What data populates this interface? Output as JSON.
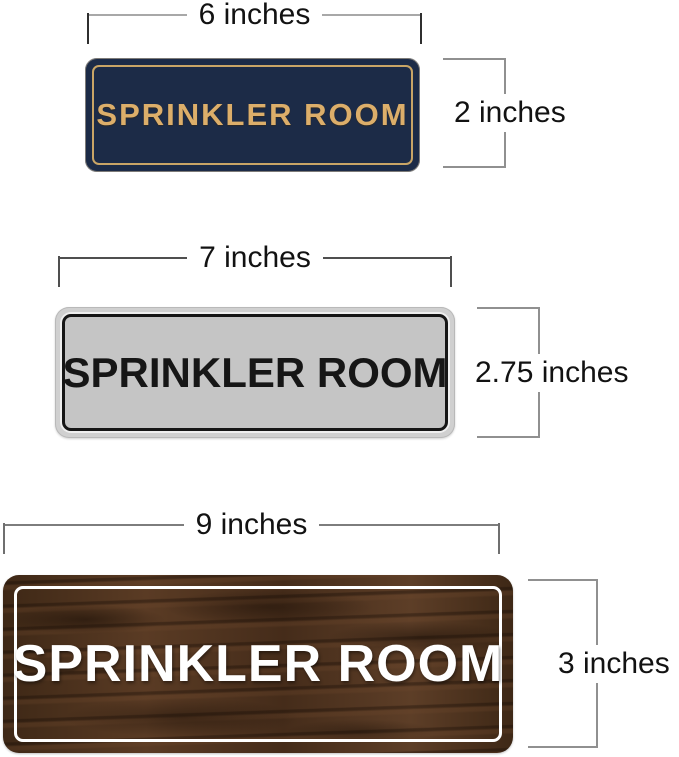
{
  "page": {
    "background": "#ffffff"
  },
  "signs": [
    {
      "name": "navy-gold-sign",
      "label": "SPRINKLER ROOM",
      "width_label": "6 inches",
      "height_label": "2 inches",
      "colors": {
        "face": "#1c2b47",
        "border": "#c9a566",
        "text": "#dcae6a"
      }
    },
    {
      "name": "silver-black-sign",
      "label": "SPRINKLER ROOM",
      "width_label": "7 inches",
      "height_label": "2.75 inches",
      "colors": {
        "face": "#d0d0d0",
        "border": "#161616",
        "text": "#161616"
      }
    },
    {
      "name": "walnut-white-sign",
      "label": "SPRINKLER ROOM",
      "width_label": "9 inches",
      "height_label": "3 inches",
      "colors": {
        "face": "#4c3220",
        "border": "#ffffff",
        "text": "#ffffff"
      }
    }
  ]
}
